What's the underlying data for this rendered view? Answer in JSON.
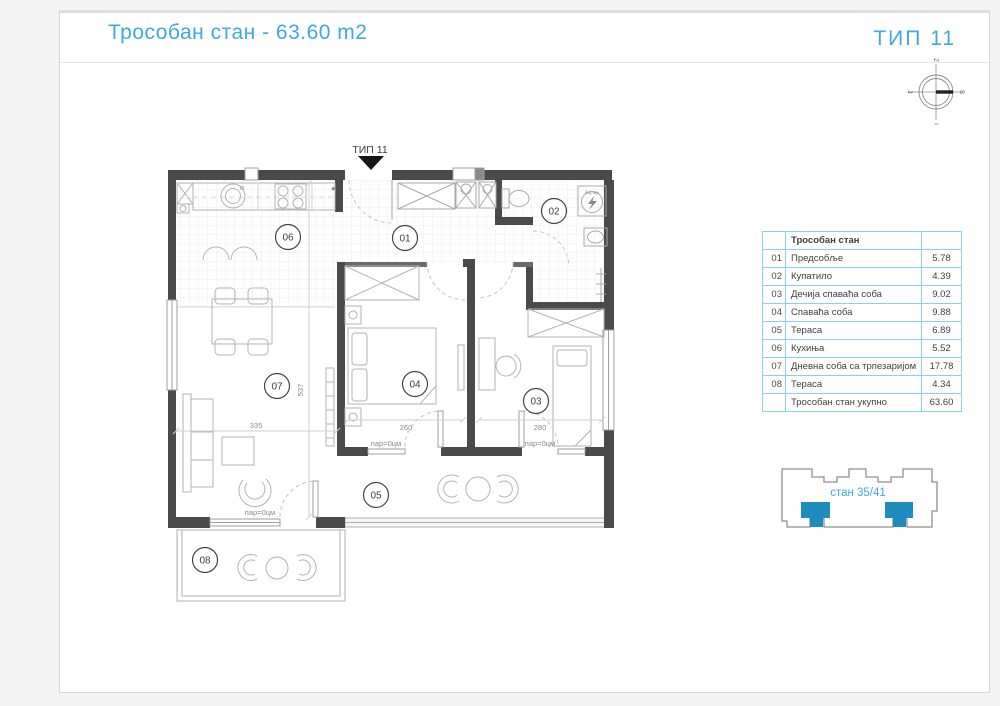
{
  "header": {
    "title": "Трособан стан - 63.60 m2",
    "type": "ТИП 11"
  },
  "plan": {
    "type_label": "ТИП 11",
    "room_numbers": [
      "01",
      "02",
      "03",
      "04",
      "05",
      "06",
      "07",
      "08"
    ],
    "dims": {
      "living_width": "335",
      "living_height": "537",
      "bedroom_width": "260",
      "kids_width": "280"
    },
    "parapet": "пар=0цм",
    "boiler": "бојлер",
    "star": "*",
    "compass": {
      "top": "Z",
      "right": "S",
      "bottom": "I",
      "left": "J"
    }
  },
  "table": {
    "header": "Трособан стан",
    "rows": [
      {
        "num": "01",
        "name": "Предсобље",
        "area": "5.78"
      },
      {
        "num": "02",
        "name": "Купатило",
        "area": "4.39"
      },
      {
        "num": "03",
        "name": "Дечија спаваћа соба",
        "area": "9.02"
      },
      {
        "num": "04",
        "name": "Спаваћа соба",
        "area": "9.88"
      },
      {
        "num": "05",
        "name": "Тераса",
        "area": "6.89"
      },
      {
        "num": "06",
        "name": "Кухиња",
        "area": "5.52"
      },
      {
        "num": "07",
        "name": "Дневна соба са трпезаријом",
        "area": "17.78"
      },
      {
        "num": "08",
        "name": "Тераса",
        "area": "4.34"
      }
    ],
    "total": {
      "num": "",
      "name": "Трособан стан укупно",
      "area": "63.60"
    }
  },
  "building": {
    "label": "стан 35/41"
  },
  "colors": {
    "accent": "#3fa9dc",
    "table_border": "#86d2ee",
    "unit_fill": "#1e8cbe",
    "wall": "#4a4a4a"
  }
}
